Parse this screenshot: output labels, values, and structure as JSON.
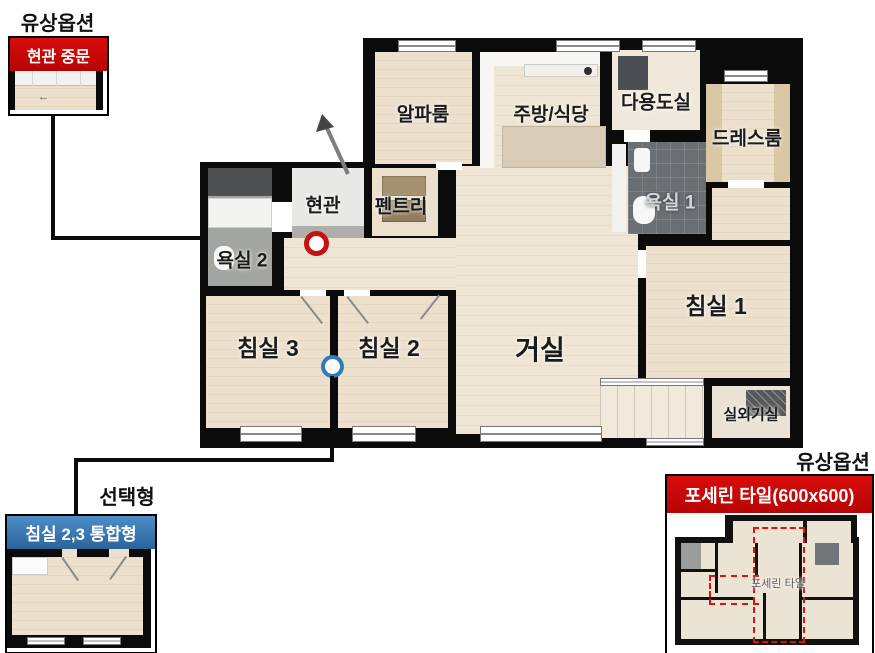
{
  "floor_plan": {
    "rooms": {
      "alpha": "알파룸",
      "kitchen_dining": "주방/식당",
      "utility": "다용도실",
      "dress_room": "드레스룸",
      "bathroom1": "욕실 1",
      "entrance": "현관",
      "pantry": "펜트리",
      "bathroom2": "욕실 2",
      "bedroom3": "침실 3",
      "bedroom2": "침실 2",
      "living": "거실",
      "bedroom1": "침실 1",
      "outdoor_unit": "실외기실"
    },
    "markers": {
      "entrance_door_marker_color": "#c41111",
      "bedroom_merge_marker_color": "#2d7cbe"
    }
  },
  "callouts": {
    "entrance_door": {
      "tag": "유상옵션",
      "title": "현관 중문",
      "accent_color": "#cb0606"
    },
    "bedroom_merge": {
      "tag": "선택형",
      "title": "침실 2,3 통합형",
      "accent_color": "#3a7cba"
    },
    "porcelain_tile": {
      "tag": "유상옵션",
      "title": "포세린 타일(600x600)",
      "accent_color": "#cb0606",
      "area_label": "포세린 타일"
    }
  }
}
